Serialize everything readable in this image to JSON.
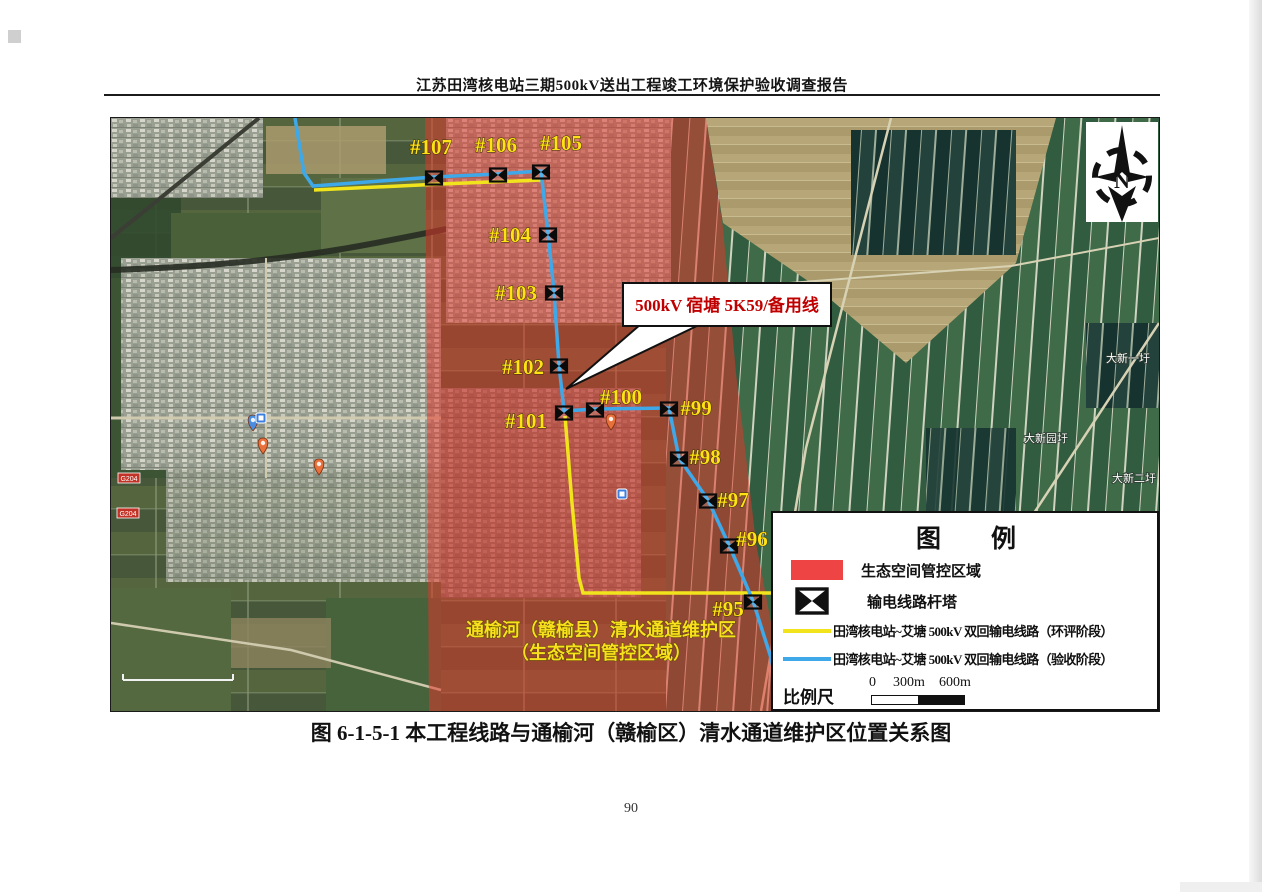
{
  "page": {
    "header": "江苏田湾核电站三期500kV送出工程竣工环境保护验收调查报告",
    "caption": "图 6-1-5-1  本工程线路与通榆河（赣榆区）清水通道维护区位置关系图",
    "page_number": "90"
  },
  "map": {
    "callout": {
      "text": "500kV 宿塘 5K59/备用线",
      "text_color": "#c00000"
    },
    "region_label": {
      "line1": "通榆河（赣榆县）清水通道维护区",
      "line2": "（生态空间管控区域）",
      "color": "#f8e11c"
    },
    "compass_letter": "N",
    "colors": {
      "control_area": "#e5352b",
      "route_eia": "#f2e41c",
      "route_acceptance": "#3ea8e8"
    },
    "routes": {
      "blue_points": "184,0 193,55 202,68 323,59 387,56 430,53 437,115 443,174 448,247 453,293 484,291 558,290 568,340 597,382 618,427 642,483 660,540 666,568",
      "yellow_a_points": "203,72 330,66 430,62",
      "yellow_b_points": "454,298 461,385 468,460 472,475 700,475"
    },
    "towers": [
      {
        "id": "#107",
        "x": 323,
        "y": 60,
        "lx": 320,
        "ly": 36
      },
      {
        "id": "#106",
        "x": 387,
        "y": 57,
        "lx": 385,
        "ly": 34
      },
      {
        "id": "#105",
        "x": 430,
        "y": 54,
        "lx": 450,
        "ly": 32
      },
      {
        "id": "#104",
        "x": 437,
        "y": 117,
        "lx": 399,
        "ly": 124
      },
      {
        "id": "#103",
        "x": 443,
        "y": 175,
        "lx": 405,
        "ly": 182
      },
      {
        "id": "#102",
        "x": 448,
        "y": 248,
        "lx": 412,
        "ly": 256
      },
      {
        "id": "#101",
        "x": 453,
        "y": 295,
        "lx": 415,
        "ly": 310
      },
      {
        "id": "#100",
        "x": 484,
        "y": 292,
        "lx": 510,
        "ly": 286
      },
      {
        "id": "#99",
        "x": 558,
        "y": 291,
        "lx": 585,
        "ly": 297
      },
      {
        "id": "#98",
        "x": 568,
        "y": 341,
        "lx": 594,
        "ly": 346
      },
      {
        "id": "#97",
        "x": 597,
        "y": 383,
        "lx": 622,
        "ly": 389
      },
      {
        "id": "#96",
        "x": 618,
        "y": 428,
        "lx": 641,
        "ly": 428
      },
      {
        "id": "#95",
        "x": 642,
        "y": 484,
        "lx": 617,
        "ly": 498
      }
    ],
    "place_labels": [
      {
        "text": "大新一圩",
        "x": 1017,
        "y": 244
      },
      {
        "text": "大新园圩",
        "x": 935,
        "y": 324
      },
      {
        "text": "大新二圩",
        "x": 1023,
        "y": 364
      }
    ],
    "road_badges": [
      {
        "text": "G204",
        "x": 18,
        "y": 361
      },
      {
        "text": "G204",
        "x": 17,
        "y": 396
      }
    ],
    "legend": {
      "title": "图　　例",
      "items": [
        {
          "label": "生态空间管控区域"
        },
        {
          "label": "输电线路杆塔"
        },
        {
          "label": "田湾核电站~艾塘 500kV 双回输电线路（环评阶段）"
        },
        {
          "label": "田湾核电站~艾塘 500kV 双回输电线路（验收阶段）"
        }
      ],
      "scale_label": "比例尺",
      "scale_ticks": [
        "0",
        "300m",
        "600m"
      ]
    }
  }
}
